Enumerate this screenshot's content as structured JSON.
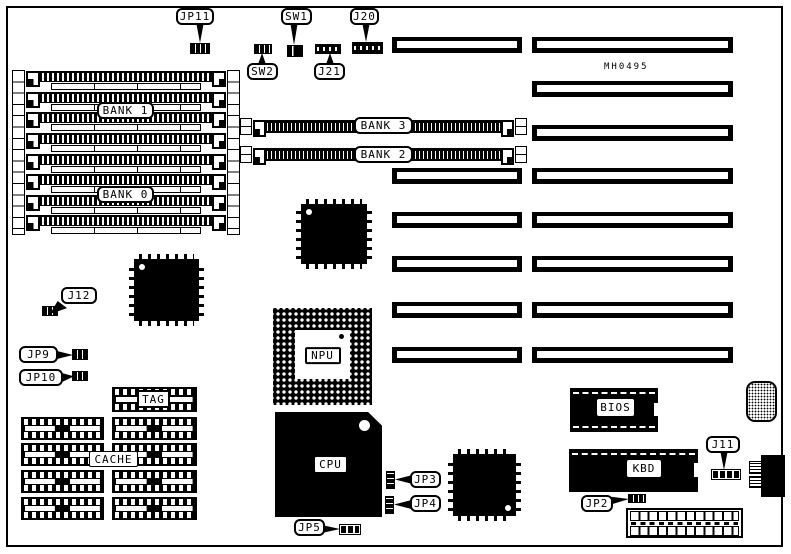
{
  "board": {
    "part_number": "MH0495",
    "memory_banks": {
      "bank0": "BANK 0",
      "bank1": "BANK 1",
      "bank2": "BANK 2",
      "bank3": "BANK 3"
    },
    "chips": {
      "npu": "NPU",
      "cpu": "CPU",
      "bios": "BIOS",
      "kbd": "KBD",
      "tag": "TAG",
      "cache": "CACHE"
    },
    "connectors": {
      "jp11": "JP11",
      "sw1": "SW1",
      "sw2": "SW2",
      "j20": "J20",
      "j21": "J21",
      "j12": "J12",
      "jp9": "JP9",
      "jp10": "JP10",
      "jp3": "JP3",
      "jp4": "JP4",
      "jp5": "JP5",
      "jp2": "JP2",
      "j11": "J11"
    },
    "colors": {
      "ink": "#000000",
      "background": "#ffffff"
    }
  }
}
